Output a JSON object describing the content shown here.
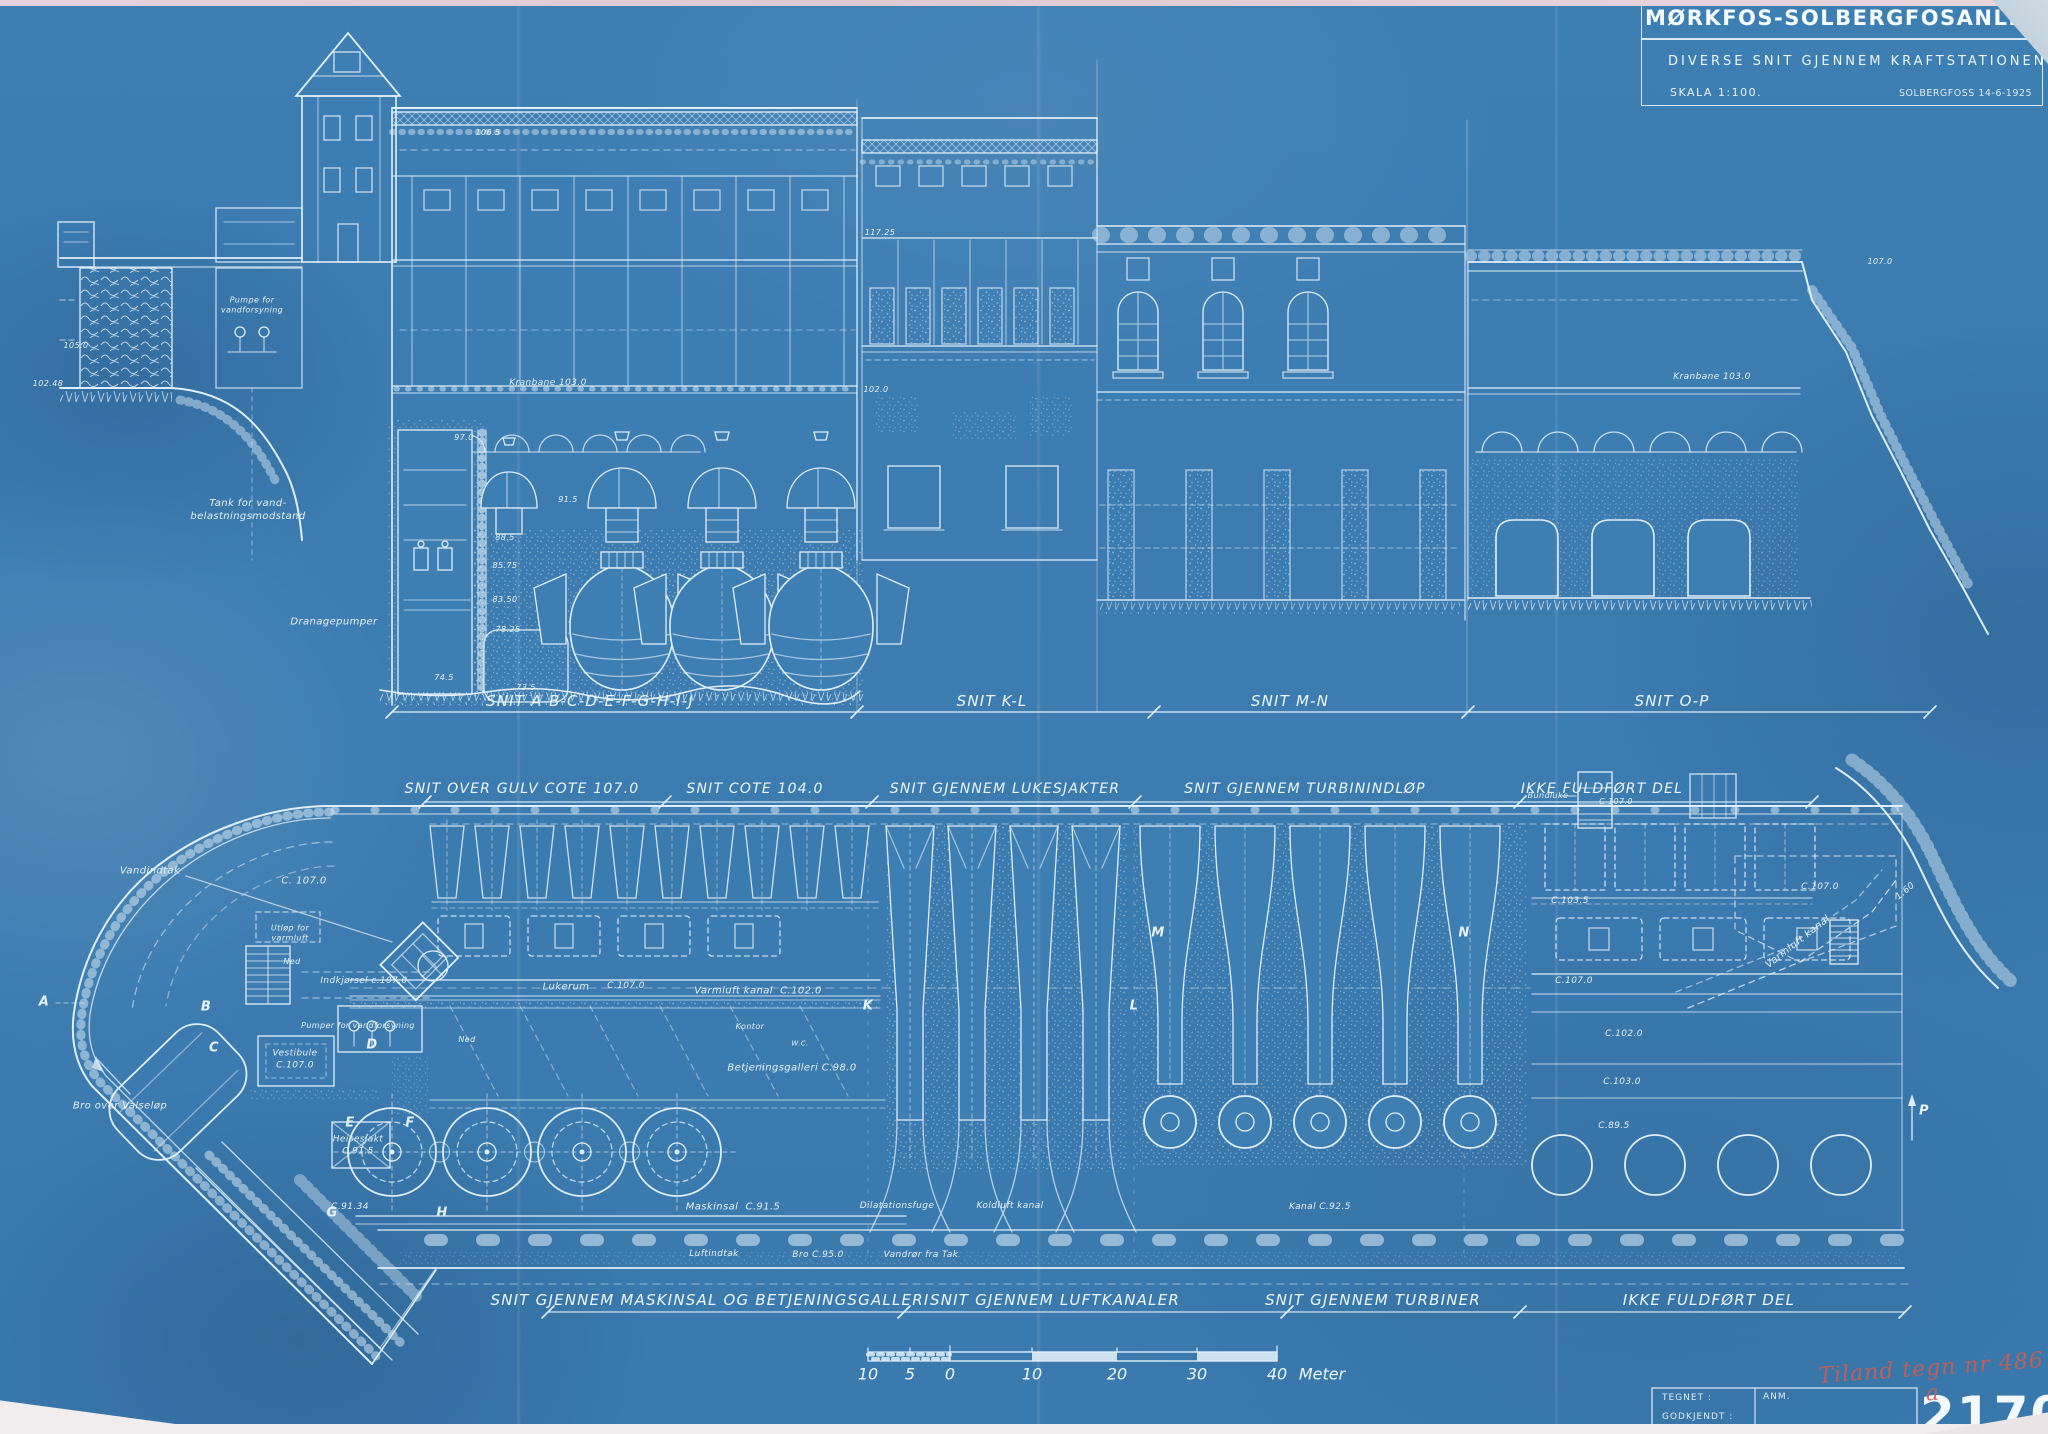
{
  "colors": {
    "paper_blue": "#3d7eb3",
    "line_white": "#e0eef8",
    "bright_white": "#f4f9fd",
    "stamp_red": "#cb5e55"
  },
  "title_block": {
    "title": "MØRKFOS-SOLBERGFOSANLEGGET",
    "subtitle": "DIVERSE SNIT GJENNEM KRAFTSTATIONEN",
    "scale": "SKALA 1:100.",
    "place_date": "SOLBERGFOSS 14-6-1925"
  },
  "section_row": {
    "labels": [
      "SNIT A-B-C-D-E-F-G-H-I-J",
      "SNIT K-L",
      "SNIT M-N",
      "SNIT O-P"
    ]
  },
  "plan_top_row": {
    "labels": [
      "SNIT OVER GULV COTE 107.0",
      "SNIT COTE 104.0",
      "SNIT GJENNEM LUKESJAKTER",
      "SNIT GJENNEM TURBININDLØP",
      "IKKE FULDFØRT DEL"
    ]
  },
  "plan_bottom_row": {
    "labels": [
      "SNIT GJENNEM MASKINSAL OG BETJENINGSGALLERI",
      "SNIT GJENNEM LUFTKANALER",
      "SNIT GJENNEM TURBINER",
      "IKKE FULDFØRT DEL"
    ]
  },
  "scale_bar": {
    "ticks": [
      "10",
      "5",
      "0",
      "10",
      "20",
      "30",
      "40"
    ],
    "unit": "Meter"
  },
  "corner_block": {
    "tegnet": "TEGNET :",
    "godkjendt": "GODKJENDT :",
    "anm": "ANM.",
    "drawing_number": "2170D",
    "handwritten_note": "Tiland tegn nr 486 a"
  },
  "annotations": [
    {
      "t": "105.0",
      "x": 76,
      "y": 346,
      "s": 8,
      "n": "elevation-label"
    },
    {
      "t": "102.48",
      "x": 48,
      "y": 384,
      "s": 8,
      "n": "elevation-label"
    },
    {
      "t": "Pumpe for\nvandforsyning",
      "x": 252,
      "y": 306,
      "s": 8,
      "n": "room-label"
    },
    {
      "t": "Tank for vand-\nbelastningsmodstand",
      "x": 248,
      "y": 510,
      "s": 10,
      "n": "room-label"
    },
    {
      "t": "Dranagepumper",
      "x": 334,
      "y": 622,
      "s": 10,
      "n": "room-label"
    },
    {
      "t": "Kranbane 103.0",
      "x": 548,
      "y": 384,
      "s": 9,
      "n": "elevation-label"
    },
    {
      "t": "106.5",
      "x": 488,
      "y": 133,
      "s": 8,
      "n": "elevation-label"
    },
    {
      "t": "97.0",
      "x": 464,
      "y": 438,
      "s": 8,
      "n": "elevation-label"
    },
    {
      "t": "91.5",
      "x": 568,
      "y": 500,
      "s": 8,
      "n": "elevation-label"
    },
    {
      "t": "88.5",
      "x": 505,
      "y": 538,
      "s": 8,
      "n": "elevation-label"
    },
    {
      "t": "85.75",
      "x": 505,
      "y": 566,
      "s": 8,
      "n": "elevation-label"
    },
    {
      "t": "83.50",
      "x": 505,
      "y": 600,
      "s": 8,
      "n": "elevation-label"
    },
    {
      "t": "78.25",
      "x": 508,
      "y": 630,
      "s": 8,
      "n": "elevation-label"
    },
    {
      "t": "74.5",
      "x": 444,
      "y": 678,
      "s": 8,
      "n": "elevation-label"
    },
    {
      "t": "73.5",
      "x": 526,
      "y": 688,
      "s": 8,
      "n": "elevation-label"
    },
    {
      "t": "117.25",
      "x": 880,
      "y": 233,
      "s": 8,
      "n": "elevation-label"
    },
    {
      "t": "102.0",
      "x": 876,
      "y": 390,
      "s": 8,
      "n": "elevation-label"
    },
    {
      "t": "107.0",
      "x": 1880,
      "y": 262,
      "s": 8,
      "n": "elevation-label"
    },
    {
      "t": "Kranbane 103.0",
      "x": 1712,
      "y": 378,
      "s": 9,
      "n": "elevation-label"
    },
    {
      "t": "Vandindtak",
      "x": 150,
      "y": 871,
      "s": 10,
      "n": "room-label"
    },
    {
      "t": "C. 107.0",
      "x": 304,
      "y": 881,
      "s": 10,
      "n": "elevation-label"
    },
    {
      "t": "Utløp for\nvarmluft",
      "x": 290,
      "y": 934,
      "s": 8,
      "n": "room-label"
    },
    {
      "t": "Ned",
      "x": 292,
      "y": 962,
      "s": 8,
      "n": "room-label"
    },
    {
      "t": "Indkjørsel c.107.0",
      "x": 364,
      "y": 982,
      "s": 9,
      "n": "room-label"
    },
    {
      "t": "Pumper for vandforsyning",
      "x": 358,
      "y": 1026,
      "s": 8,
      "n": "room-label"
    },
    {
      "t": "Vestibule\nC.107.0",
      "x": 295,
      "y": 1060,
      "s": 9,
      "n": "room-label"
    },
    {
      "t": "Heisesjakt\nC.91.5",
      "x": 358,
      "y": 1146,
      "s": 9,
      "n": "room-label"
    },
    {
      "t": "C.91.34",
      "x": 350,
      "y": 1208,
      "s": 9,
      "n": "elevation-label"
    },
    {
      "t": "Bro over Valseløp",
      "x": 120,
      "y": 1106,
      "s": 10,
      "n": "room-label"
    },
    {
      "t": "Lukerum",
      "x": 566,
      "y": 987,
      "s": 10,
      "n": "room-label"
    },
    {
      "t": "C.107.0",
      "x": 626,
      "y": 987,
      "s": 9,
      "n": "elevation-label"
    },
    {
      "t": "Varmluft kanal  C.102.0",
      "x": 758,
      "y": 991,
      "s": 10,
      "n": "room-label"
    },
    {
      "t": "Ned",
      "x": 467,
      "y": 1040,
      "s": 8,
      "n": "room-label"
    },
    {
      "t": "Kontor",
      "x": 750,
      "y": 1027,
      "s": 8,
      "n": "room-label"
    },
    {
      "t": "W.C.",
      "x": 800,
      "y": 1044,
      "s": 7,
      "n": "room-label"
    },
    {
      "t": "Betjeningsgalleri C.98.0",
      "x": 792,
      "y": 1068,
      "s": 10,
      "n": "room-label"
    },
    {
      "t": "Maskinsal  C.91.5",
      "x": 733,
      "y": 1207,
      "s": 10,
      "n": "room-label"
    },
    {
      "t": "Dilatationsfuge",
      "x": 897,
      "y": 1207,
      "s": 9,
      "n": "room-label"
    },
    {
      "t": "Koldluft kanal",
      "x": 1010,
      "y": 1207,
      "s": 9,
      "n": "room-label"
    },
    {
      "t": "Kanal C.92.5",
      "x": 1320,
      "y": 1208,
      "s": 9,
      "n": "room-label"
    },
    {
      "t": "Luftindtak",
      "x": 714,
      "y": 1255,
      "s": 9,
      "n": "room-label"
    },
    {
      "t": "Bro C.95.0",
      "x": 818,
      "y": 1256,
      "s": 9,
      "n": "room-label"
    },
    {
      "t": "Vandrør fra Tak",
      "x": 921,
      "y": 1256,
      "s": 9,
      "n": "room-label"
    },
    {
      "t": "Varmluft kanal",
      "x": 1798,
      "y": 942,
      "s": 10,
      "r": -38,
      "n": "room-label"
    },
    {
      "t": "C.107.0",
      "x": 1820,
      "y": 888,
      "s": 9,
      "n": "elevation-label"
    },
    {
      "t": "C.103.5",
      "x": 1570,
      "y": 902,
      "s": 9,
      "n": "elevation-label"
    },
    {
      "t": "C.107.0",
      "x": 1574,
      "y": 982,
      "s": 9,
      "n": "elevation-label"
    },
    {
      "t": "C.102.0",
      "x": 1624,
      "y": 1035,
      "s": 9,
      "n": "elevation-label"
    },
    {
      "t": "C.103.0",
      "x": 1622,
      "y": 1083,
      "s": 9,
      "n": "elevation-label"
    },
    {
      "t": "C.89.5",
      "x": 1614,
      "y": 1127,
      "s": 9,
      "n": "elevation-label"
    },
    {
      "t": "Bundluke",
      "x": 1548,
      "y": 796,
      "s": 8,
      "n": "room-label"
    },
    {
      "t": "C 107.0",
      "x": 1616,
      "y": 802,
      "s": 8,
      "n": "elevation-label"
    },
    {
      "t": "1:60",
      "x": 1906,
      "y": 892,
      "s": 9,
      "r": -40,
      "n": "slope-label"
    },
    {
      "t": "A",
      "x": 44,
      "y": 1003,
      "s": 13,
      "n": "section-point-letter"
    },
    {
      "t": "B",
      "x": 206,
      "y": 1008,
      "s": 13,
      "n": "section-point-letter"
    },
    {
      "t": "C",
      "x": 214,
      "y": 1049,
      "s": 13,
      "n": "section-point-letter"
    },
    {
      "t": "D",
      "x": 372,
      "y": 1046,
      "s": 13,
      "n": "section-point-letter"
    },
    {
      "t": "E",
      "x": 350,
      "y": 1124,
      "s": 13,
      "n": "section-point-letter"
    },
    {
      "t": "F",
      "x": 410,
      "y": 1124,
      "s": 13,
      "n": "section-point-letter"
    },
    {
      "t": "G",
      "x": 332,
      "y": 1214,
      "s": 13,
      "n": "section-point-letter"
    },
    {
      "t": "H",
      "x": 442,
      "y": 1214,
      "s": 13,
      "n": "section-point-letter"
    },
    {
      "t": "K",
      "x": 868,
      "y": 1007,
      "s": 13,
      "n": "section-point-letter"
    },
    {
      "t": "L",
      "x": 1134,
      "y": 1007,
      "s": 13,
      "n": "section-point-letter"
    },
    {
      "t": "M",
      "x": 1158,
      "y": 934,
      "s": 13,
      "n": "section-point-letter"
    },
    {
      "t": "N",
      "x": 1464,
      "y": 934,
      "s": 13,
      "n": "section-point-letter"
    },
    {
      "t": "P",
      "x": 1924,
      "y": 1112,
      "s": 13,
      "n": "section-point-letter"
    }
  ]
}
